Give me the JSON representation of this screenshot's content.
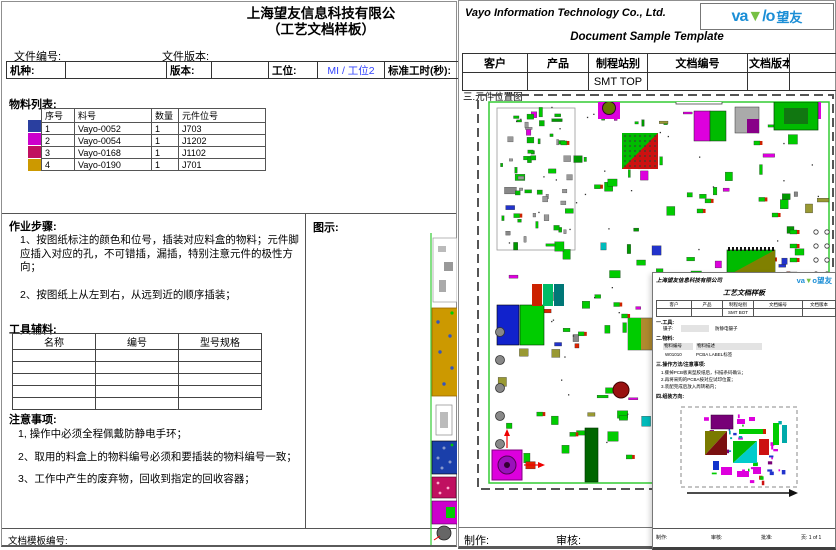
{
  "colors": {
    "logo_blue": "#1b8ed6",
    "logo_green": "#76c043",
    "station_blue": "#3344ff",
    "board_green": "#33cc33"
  },
  "left_page": {
    "company_title": "上海望友信息科技有限公",
    "subtitle": "（工艺文档样板）",
    "file_no_label": "文件编号:",
    "file_ver_label": "文件版本:",
    "spec": {
      "machine_label": "机种:",
      "version_label": "版本:",
      "station_label": "工位:",
      "station_value": "MI / 工位2",
      "std_time_label": "标准工时(秒):"
    },
    "bom": {
      "title": "物料列表:",
      "headers": [
        "序号",
        "料号",
        "数量",
        "元件位号"
      ],
      "rows": [
        {
          "color": "#2a3f9f",
          "seq": "1",
          "part": "Vayo-0052",
          "qty": "1",
          "ref": "J703"
        },
        {
          "color": "#cc00cc",
          "seq": "2",
          "part": "Vayo-0054",
          "qty": "1",
          "ref": "J1202"
        },
        {
          "color": "#c01060",
          "seq": "3",
          "part": "Vayo-0168",
          "qty": "1",
          "ref": "J1102"
        },
        {
          "color": "#cc9900",
          "seq": "4",
          "part": "Vayo-0190",
          "qty": "1",
          "ref": "J701"
        }
      ]
    },
    "steps": {
      "title": "作业步骤:",
      "items": [
        "1、按图纸标注的颜色和位号，插装对应料盒的物料；元件脚应插入对应的孔，不可错插，漏插，特别注意元件的极性方向；",
        "2、按图纸上从左到右，从远到近的顺序插装；"
      ]
    },
    "illustration_label": "图示:",
    "tools": {
      "title": "工具辅料:",
      "headers": [
        "名称",
        "编号",
        "型号规格"
      ],
      "empty_rows": 5
    },
    "notes": {
      "title": "注意事项:",
      "items": [
        "1, 操作中必须全程佩戴防静电手环；",
        "2、取用的料盒上的物料编号必须和要插装的物料编号一致；",
        "3、工作中产生的废弃物，回收到指定的回收容器；"
      ]
    },
    "footer_label": "文档模板编号:"
  },
  "right_page": {
    "company_name": "Vayo Information Technology Co., Ltd.",
    "doc_title": "Document Sample Template",
    "logo": {
      "prefix": "va",
      "glyph": "▼",
      "slash": "/",
      "suffix": "o",
      "cn": "望友"
    },
    "info": {
      "headers": [
        "客户",
        "产品",
        "制程站别",
        "文档编号",
        "文档版本",
        ""
      ],
      "station_value": "SMT TOP"
    },
    "section_label": "三.元件位置图",
    "maker_label": "制作:",
    "checker_label": "审核:"
  },
  "overlay": {
    "company_name": "上海望友信息科技有限公司",
    "logo": {
      "prefix": "va",
      "glyph": "▼",
      "slash": "/",
      "suffix": "o",
      "cn": "望友"
    },
    "title": "工艺文档样板",
    "info": {
      "headers": [
        "客户",
        "产品",
        "制程站别",
        "文档编号",
        "文档版本"
      ],
      "station_value": "SMT BOT"
    },
    "tools_label": "一.工具:",
    "tool_name_label": "镊子:",
    "tool_value": "防静电镊子",
    "material_label": "二.物料:",
    "mat_headers": [
      "物料编号",
      "物料描述"
    ],
    "mat_row": [
      "W01010",
      "PCBA LABEL标签"
    ],
    "method_label": "三.操作方法/注意事项:",
    "method_items": [
      "1.撕掉PCB板离型胶纸后，扫描条码确认；",
      "2.再将采购的PCBA按对应试印位置；",
      "3.装配完成后放入周转箱内；"
    ],
    "direction_label": "四.组装方向:",
    "footer": {
      "maker": "制作:",
      "checker": "审核:",
      "approver": "批准:",
      "page": "页: 1 of 1"
    }
  }
}
